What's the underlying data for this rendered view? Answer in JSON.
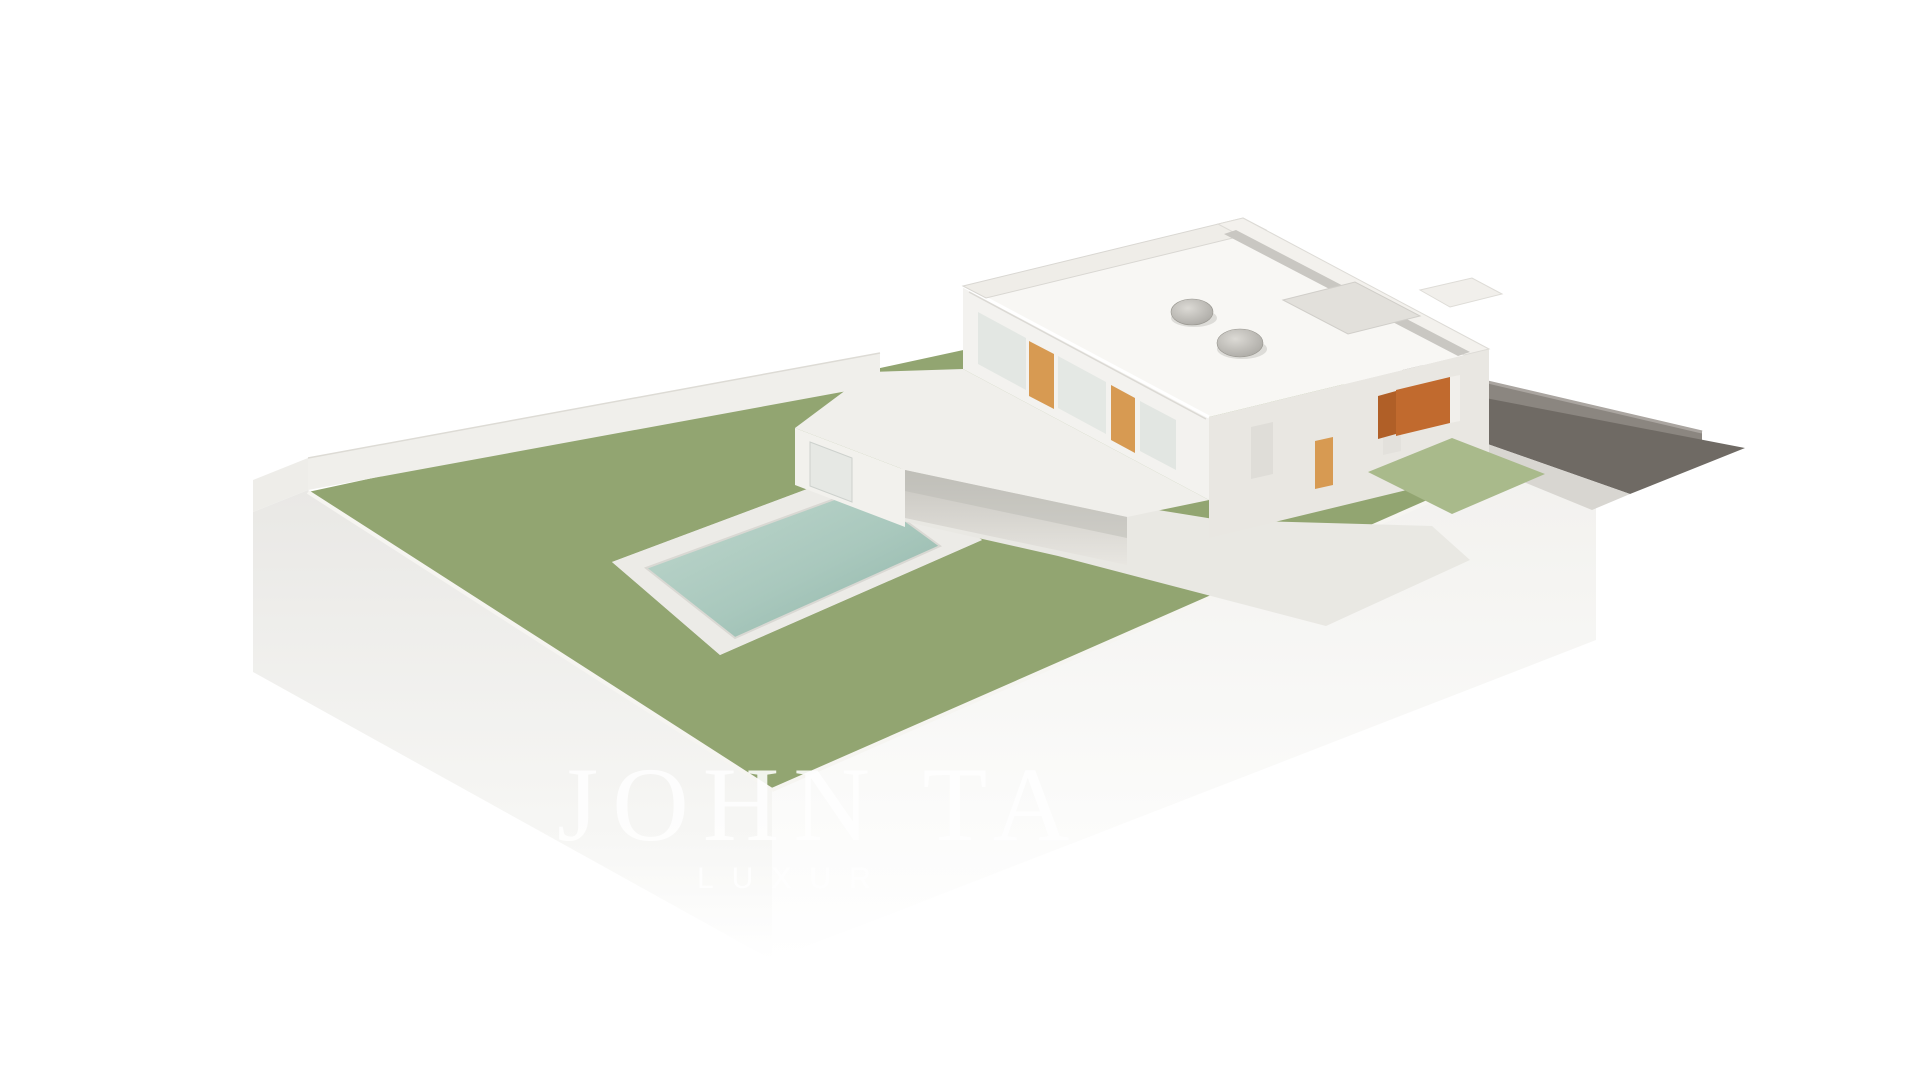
{
  "watermark": {
    "brand_text": "JOHN TA",
    "tagline_text": "LUXUR"
  },
  "scene": {
    "description": "Aerial axonometric 3D architectural rendering of a modern two-storey white villa on a landscaped plot, presented as a model on a white plinth",
    "elements": [
      "flat-roof white villa with two dome skylights and recessed roof terrace",
      "first-floor terrace with grid parapet and grey lounge furniture",
      "covered ground-floor patio with sofa, coffee tables and dining set",
      "rectangular swimming pool with white surrounding deck and sun lounger",
      "stepping-stone path across the lawn",
      "large grass garden",
      "white perimeter railing fence",
      "rear boundary wall with flower bed",
      "palm tree and birch trees",
      "flower clusters in magenta and pink",
      "dark sunken driveway ramp with retaining walls",
      "orange brick entrance gate",
      "white model plinth fading to white background"
    ]
  },
  "colors": {
    "background": "#ffffff",
    "grass": "#92a571",
    "grass_light": "#a9ba8b",
    "grass_dark": "#7d935c",
    "pool_water": "#a9c8bd",
    "pool_water_deep": "#8fb4a8",
    "deck": "#ececе8",
    "house_white": "#f3f2ef",
    "house_shadow": "#e9e7e2",
    "roof_white": "#f8f7f4",
    "patio_shadow": "#d2d0ca",
    "orange_panel": "#d79a52",
    "orange_gate": "#c16a2e",
    "driveway": "#6f6a64",
    "retaining_wall": "#8b8680",
    "fence": "#e6e4da",
    "tree_green": "#9db37c",
    "tree_green_light": "#c3cfa4",
    "tree_green_pale": "#d6dec2",
    "palm_frond": "#c6cda6",
    "trunk": "#b9ab92",
    "flower_magenta": "#a8486b",
    "flower_pink": "#d089a5",
    "plinth_left": "#e9e8e5",
    "plinth_front": "#f2f1ee",
    "watermark": "#ffffff"
  }
}
